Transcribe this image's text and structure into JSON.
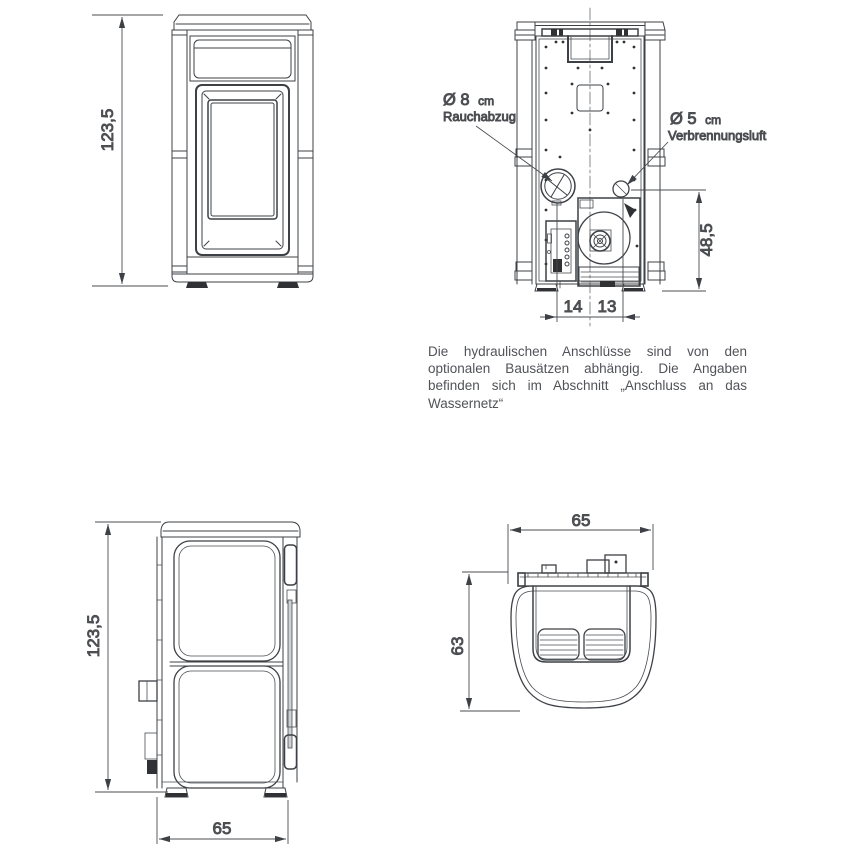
{
  "palette": {
    "line_color": "#3d4045",
    "dark_fill": "#2f3134",
    "text_color": "#525459"
  },
  "front_view": {
    "height_dim": "123,5"
  },
  "rear_view": {
    "smoke_label_value": "Ø 8",
    "smoke_label_unit": "cm",
    "smoke_label_name": "Rauchabzug",
    "air_label_value": "Ø 5",
    "air_label_unit": "cm",
    "air_label_name": "Verbrennungsluft",
    "air_height_dim": "48,5",
    "offset_left_dim": "14",
    "offset_right_dim": "13"
  },
  "side_view": {
    "height_dim": "123,5",
    "depth_dim": "65"
  },
  "top_view": {
    "width_dim": "65",
    "depth_dim": "63"
  },
  "note": {
    "line1": "Die hydraulischen Anschlüsse sind von den",
    "line2": "optionalen Bausätzen abhängig. Die Angaben",
    "line3": "befinden sich im Abschnitt „Anschluss an das",
    "line4": "Wassernetz“"
  }
}
